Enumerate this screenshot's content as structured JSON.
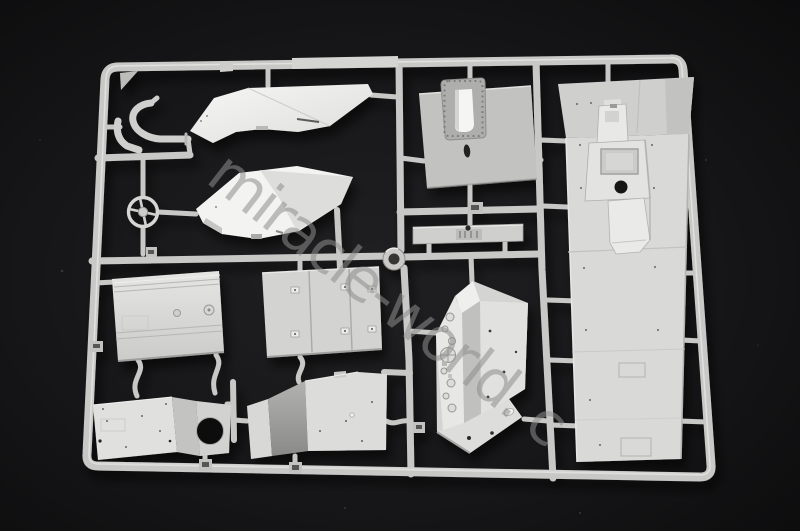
{
  "scene": {
    "description": "Photograph of a light grey injection-moulded model kit sprue (parts frame) with flat hull panels, hatches, a steering wheel and pipe parts, lying on a dark background",
    "background_hex": "#121214",
    "plastic_hex": "#c9c9c7",
    "part_highlight_hex": "#f2f2f0",
    "shadow_hex": "#8f8f8d"
  },
  "watermark": {
    "text": "miracle-world. c",
    "angle_deg": 38,
    "color_hex": "#8e8e8e",
    "opacity": 0.55
  },
  "parts": [
    {
      "id": "sprue-frame",
      "desc": "outer rectangular runner frame with internal runners"
    },
    {
      "id": "exhaust-pipe",
      "desc": "curved pipe part, top left"
    },
    {
      "id": "steering-wheel",
      "desc": "four-spoke wheel part"
    },
    {
      "id": "hull-side-panel-upper",
      "desc": "bright angular panel, top centre"
    },
    {
      "id": "hull-side-panel-lower",
      "desc": "bright angular panel below it"
    },
    {
      "id": "hatch-plate",
      "desc": "plate with riveted hatch opening and oval hole"
    },
    {
      "id": "axle-strip",
      "desc": "thin strip part with centre fitting"
    },
    {
      "id": "pulley-ring",
      "desc": "small round part on runner junction"
    },
    {
      "id": "engine-deck-panel",
      "desc": "lined rectangular panel, mid left"
    },
    {
      "id": "three-section-panel",
      "desc": "panel with two vertical ribs and clamps"
    },
    {
      "id": "firewall-instrument-panel",
      "desc": "faceted part with gauge dials"
    },
    {
      "id": "fan-housing-panel",
      "desc": "angled panel with large round hole"
    },
    {
      "id": "angled-floor-panel",
      "desc": "angled folded panel, bottom centre"
    },
    {
      "id": "hull-floor-deck",
      "desc": "long deck part with transmission tunnel, right side"
    }
  ]
}
